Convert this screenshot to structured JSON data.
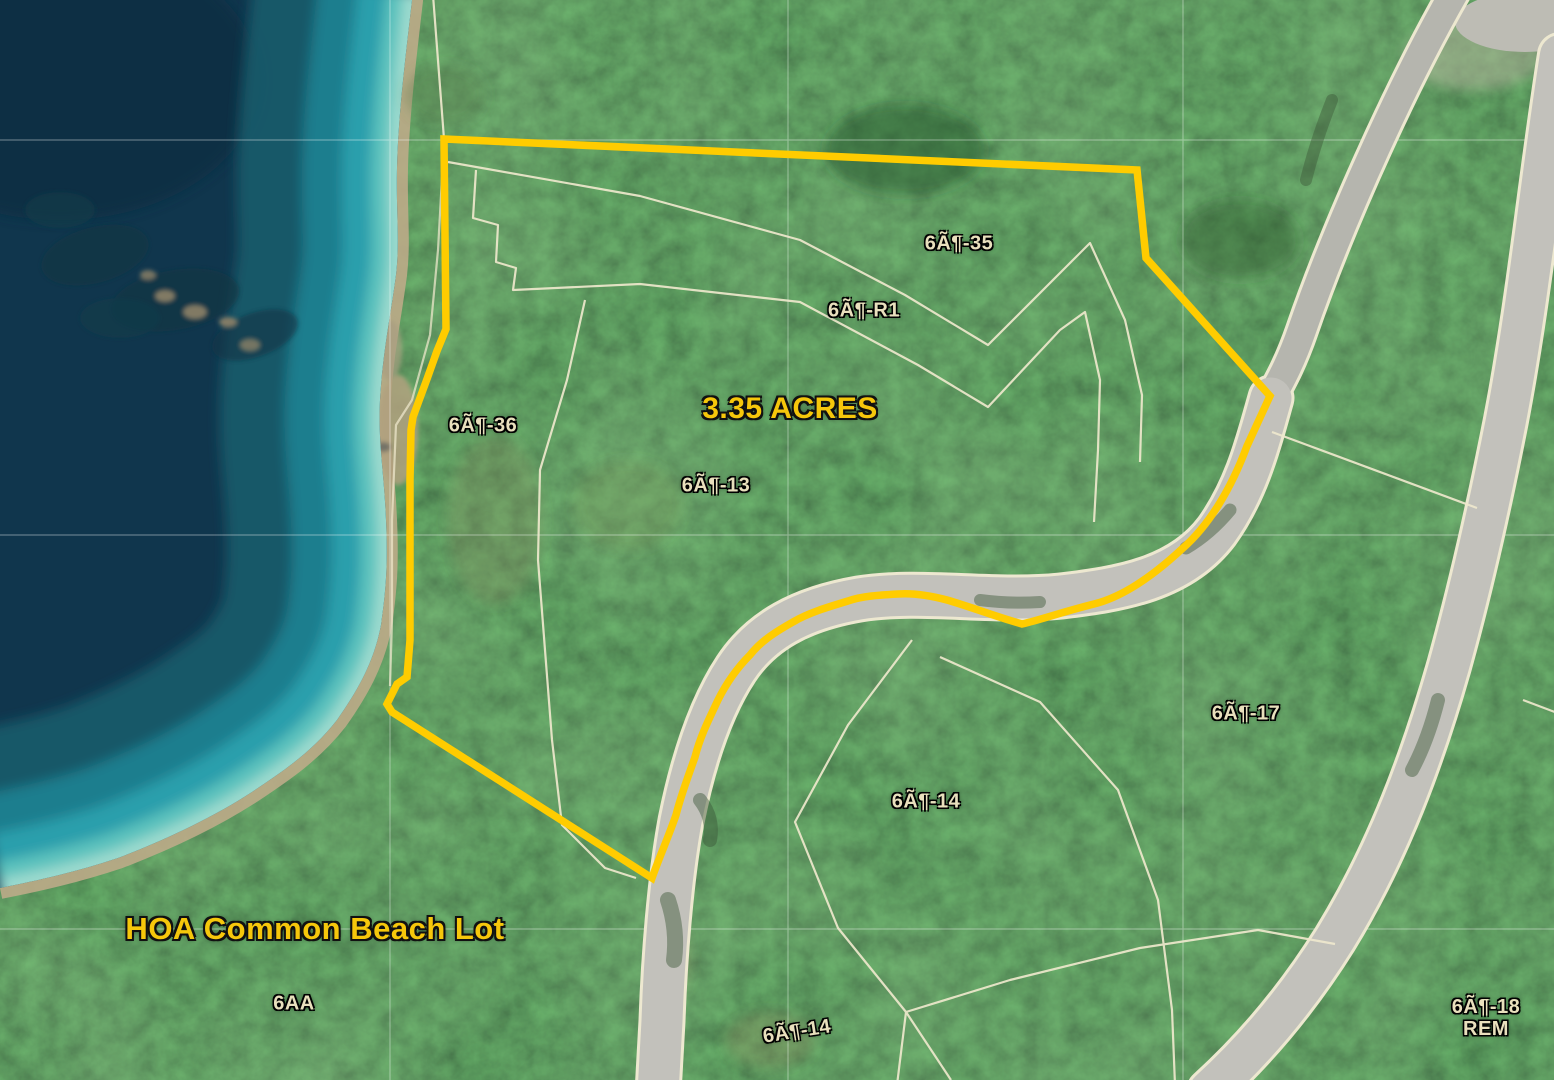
{
  "map": {
    "type": "aerial-parcel-map",
    "area_callout": "3.35 ACRES",
    "hoa_callout": "HOA Common Beach Lot",
    "parcels": {
      "lot35": "6Ã¶-35",
      "lotR1": "6Ã¶-R1",
      "lot36": "6Ã¶-36",
      "lot13": "6Ã¶-13",
      "lot17": "6Ã¶-17",
      "lot14": "6Ã¶-14",
      "lot14_south": "6Ã¶-14",
      "lot6AA": "6AA",
      "lot18": "6Ã¶-18",
      "lot18_rem": "REM"
    },
    "colors": {
      "subject_boundary": "#FFCC00",
      "callout_text": "#F6C70B",
      "parcel_text": "#E9E0BD",
      "parcel_lines": "#EFE9CD",
      "road": "#C2C1BB",
      "water_deep": "#10364D",
      "water_shallow": "#A2DCD0",
      "forest": "#27492A"
    }
  }
}
